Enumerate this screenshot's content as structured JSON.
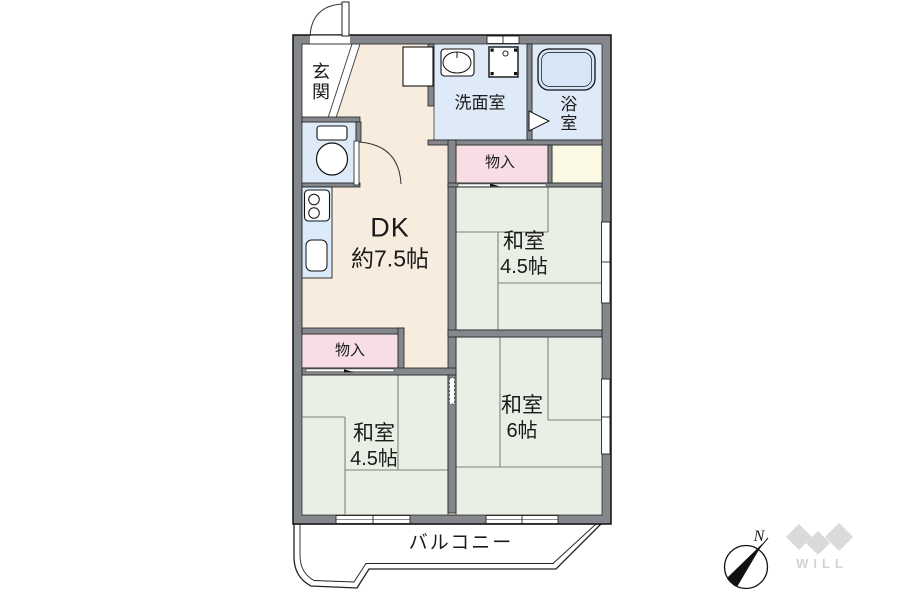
{
  "floorplan": {
    "rooms": {
      "entrance": {
        "label": "玄関"
      },
      "washroom": {
        "label": "洗面室"
      },
      "bathroom": {
        "label": "浴室"
      },
      "storage_top": {
        "label": "物入"
      },
      "storage_left": {
        "label": "物入"
      },
      "dining_kitchen": {
        "label": "DK",
        "size": "約7.5帖"
      },
      "japanese_room_upper_right": {
        "label": "和室",
        "size": "4.5帖"
      },
      "japanese_room_lower_right": {
        "label": "和室",
        "size": "6帖"
      },
      "japanese_room_lower_left": {
        "label": "和室",
        "size": "4.5帖"
      },
      "balcony": {
        "label": "バルコニー"
      }
    },
    "compass": {
      "north_label": "N"
    },
    "logo": {
      "text": "WILL"
    },
    "colors": {
      "wall_gray": "#84878c",
      "dk_floor_beige": "#f7ecdd",
      "tatami_green": "#e9efe4",
      "water_room_blue": "#dfeaf8",
      "storage_pink": "#f8dee4",
      "closet_cream": "#fbf9e4",
      "fixture_blue": "#d7e6f6",
      "line_black": "#1a1a1a",
      "logo_gray": "#d9dadb"
    }
  }
}
